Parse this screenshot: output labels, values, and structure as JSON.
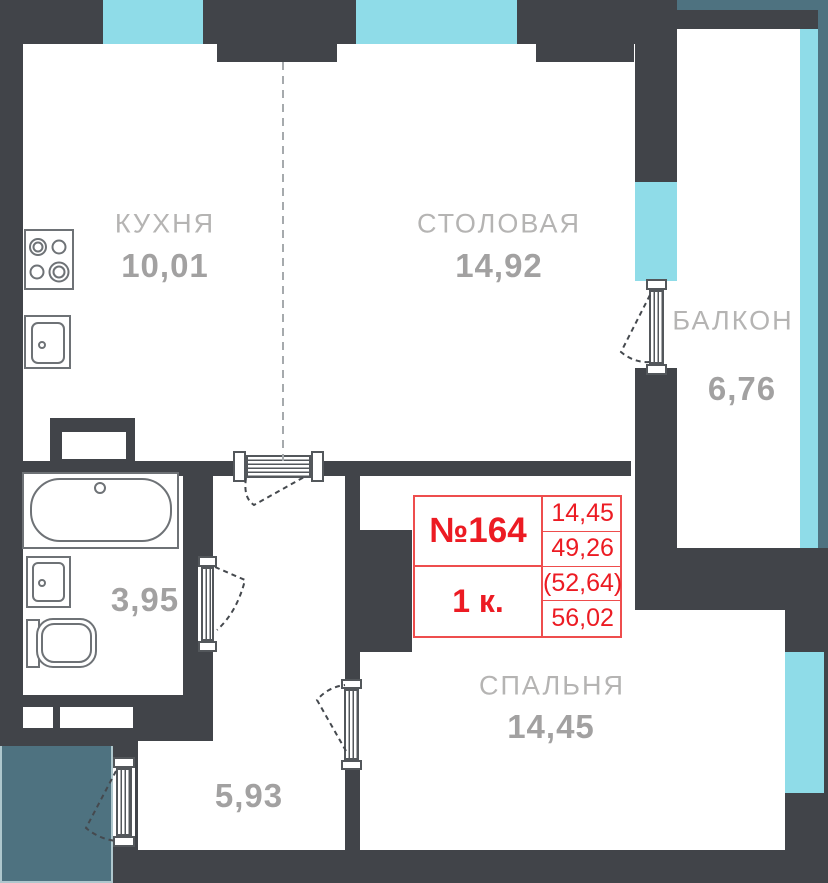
{
  "plan_title": "Floor plan of apartment unit",
  "unit": {
    "number": "№164",
    "type": "1 к.",
    "values": [
      "14,45",
      "49,26",
      "(52,64)",
      "56,02"
    ]
  },
  "rooms": {
    "kitchen": {
      "name": "КУХНЯ",
      "area": "10,01"
    },
    "dining": {
      "name": "СТОЛОВАЯ",
      "area": "14,92"
    },
    "balcony": {
      "name": "БАЛКОН",
      "area": "6,76"
    },
    "bedroom": {
      "name": "СПАЛЬНЯ",
      "area": "14,45"
    },
    "bathroom": {
      "name": "",
      "area": "3,95"
    },
    "hallway": {
      "name": "",
      "area": "5,93"
    }
  },
  "colors": {
    "wall": "#414449",
    "window_glazing": "#8FDCE8",
    "neighbor_zone": "#4E7280",
    "unit_accent_red": "#EC1B23",
    "label_gray": "#A2A1A1",
    "fixture_outline": "#6E7276"
  }
}
